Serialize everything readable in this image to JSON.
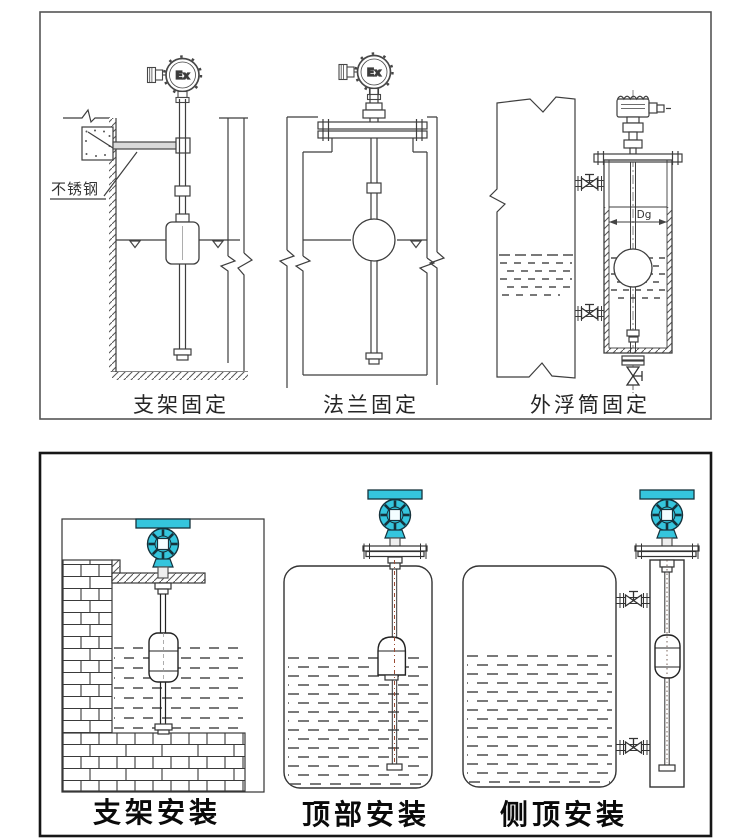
{
  "panel_top": {
    "title_labels": [
      "支架固定",
      "法兰固定",
      "外浮筒固定"
    ],
    "annotations": {
      "stainless_steel": "不锈钢",
      "ex_marking": "Ex",
      "chamber_diameter": "Dg"
    }
  },
  "panel_bottom": {
    "title_labels": [
      "支架安装",
      "顶部安装",
      "侧顶安装"
    ]
  },
  "colors": {
    "transmitter_body": "#35c5dd",
    "transmitter_outline": "#16323c",
    "line": "#3e3e3e",
    "centerline_red": "#9a4a33",
    "panel_top_border": "#555555",
    "panel_bottom_border": "#161616"
  }
}
